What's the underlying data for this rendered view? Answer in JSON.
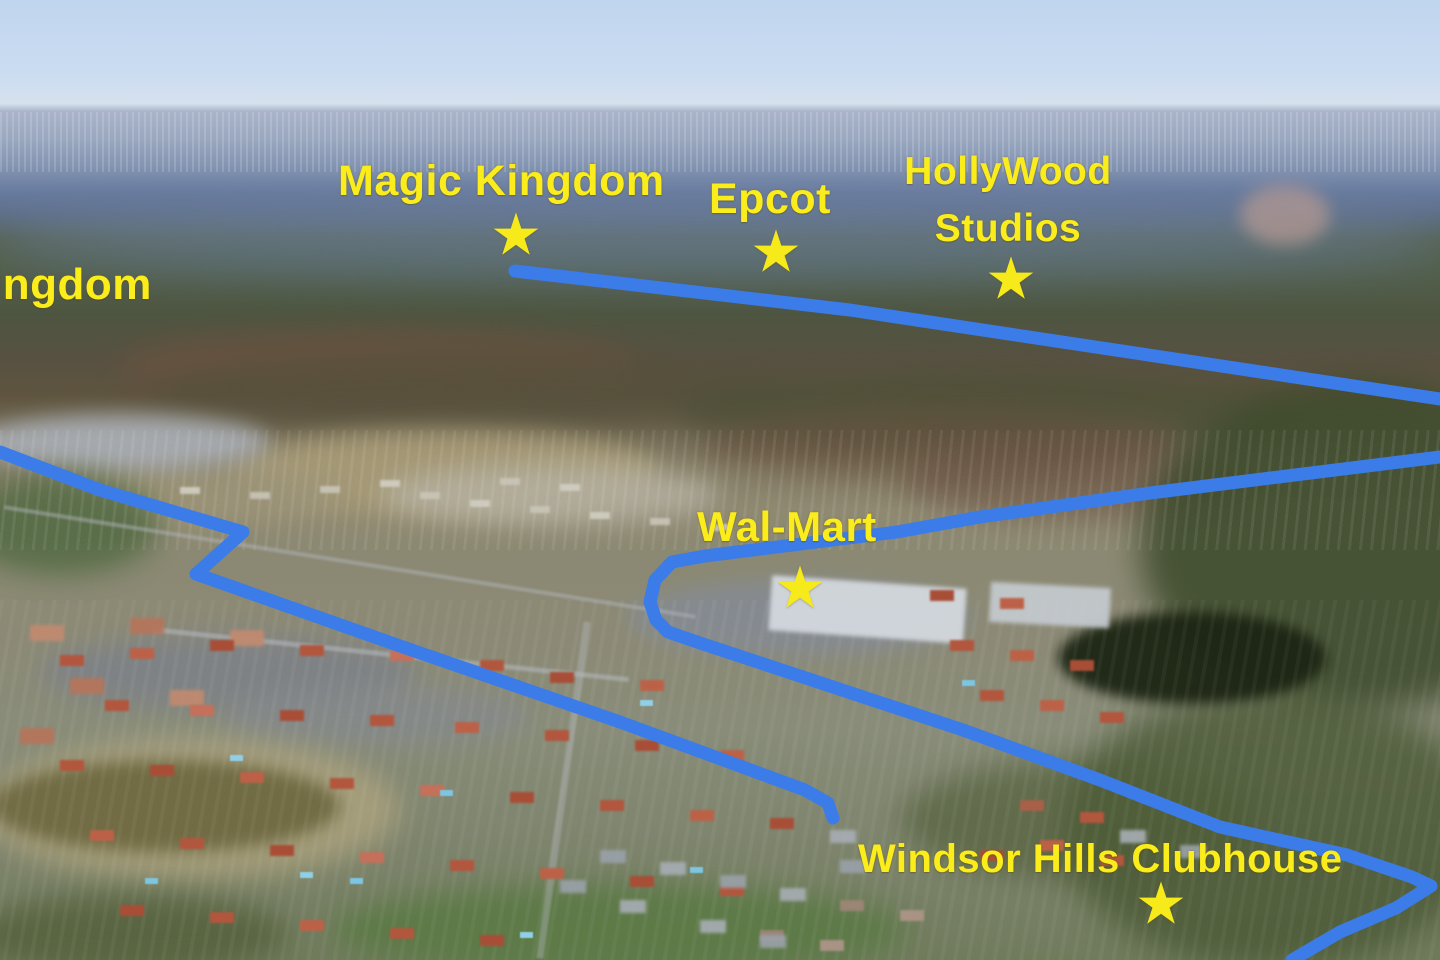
{
  "map": {
    "description": "aerial-photo-with-route-annotations",
    "colors": {
      "route_blue": "#3b7ce8",
      "label_yellow": "#fbec1c",
      "star_yellow": "#f7ea1b"
    },
    "star_glyph": "★",
    "labels": {
      "animal_kingdom_partial": "ingdom",
      "magic_kingdom": "Magic Kingdom",
      "epcot": "Epcot",
      "hollywood_line1": "HollyWood",
      "hollywood_line2": "Studios",
      "walmart": "Wal-Mart",
      "windsor_clubhouse": "Windsor Hills Clubhouse"
    },
    "markers": [
      {
        "name": "magic-kingdom-star",
        "x": 516,
        "y": 237
      },
      {
        "name": "epcot-star",
        "x": 776,
        "y": 254
      },
      {
        "name": "hollywood-studios-star",
        "x": 1011,
        "y": 281
      },
      {
        "name": "walmart-star",
        "x": 800,
        "y": 590
      },
      {
        "name": "windsor-hills-clubhouse-star",
        "x": 1161,
        "y": 906
      }
    ],
    "routes": [
      {
        "name": "route-north-to-parks",
        "points": [
          [
            515,
            271
          ],
          [
            850,
            310
          ],
          [
            1440,
            399
          ]
        ]
      },
      {
        "name": "route-walmart-loop",
        "points": [
          [
            1440,
            457
          ],
          [
            1150,
            493
          ],
          [
            980,
            517
          ],
          [
            897,
            532
          ],
          [
            705,
            556
          ],
          [
            672,
            562
          ],
          [
            655,
            580
          ],
          [
            650,
            602
          ],
          [
            656,
            620
          ],
          [
            668,
            632
          ],
          [
            700,
            643
          ],
          [
            963,
            730
          ],
          [
            1100,
            780
          ],
          [
            1220,
            827
          ],
          [
            1347,
            855
          ],
          [
            1412,
            877
          ],
          [
            1431,
            886
          ],
          [
            1396,
            908
          ],
          [
            1340,
            932
          ],
          [
            1292,
            960
          ]
        ]
      },
      {
        "name": "route-west",
        "points": [
          [
            0,
            452
          ],
          [
            100,
            490
          ],
          [
            243,
            532
          ],
          [
            196,
            574
          ],
          [
            400,
            646
          ],
          [
            620,
            722
          ],
          [
            805,
            790
          ],
          [
            828,
            803
          ],
          [
            833,
            818
          ]
        ]
      }
    ],
    "route_stroke_width": 13
  }
}
